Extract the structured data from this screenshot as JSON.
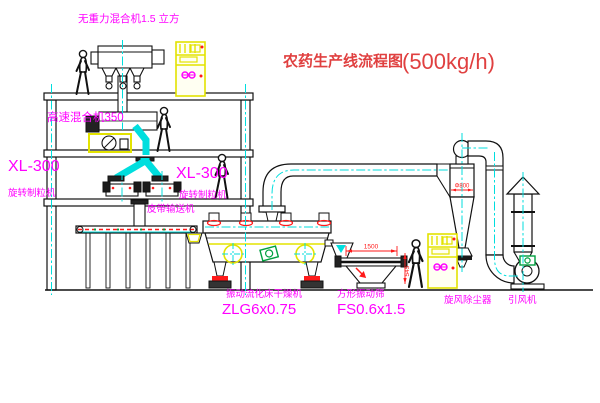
{
  "title": {
    "text_zh": "农药生产线流程图",
    "capacity": "(500kg/h)"
  },
  "labels": {
    "gravity_mixer": "无重力混合机1.5 立方",
    "high_speed_mixer": "高速混合机350",
    "granulator_model_left": "XL-300",
    "granulator_name_left": "旋转制粒机",
    "granulator_model_right": "XL-300",
    "granulator_name_right": "旋转制粒机",
    "belt_conveyor": "皮带输送机",
    "dryer_name": "振动流化床干燥机",
    "dryer_model": "ZLG6x0.75",
    "sieve_name": "方形振动筛",
    "sieve_model": "FS0.6x1.5",
    "cyclone_name": "旋风除尘器",
    "fan_name": "引风机"
  },
  "dimensions": {
    "cyclone_diameter": "Φ800",
    "sieve_length": "1500",
    "sieve_height": "545"
  },
  "colors": {
    "title_red": "#e04040",
    "dim_red": "#ff1a1a",
    "label_magenta": "#ff00ff",
    "highlight_yellow": "#eded00",
    "centerline_cyan": "#00dede",
    "motor_green": "#00a040",
    "line_black": "#000000"
  }
}
